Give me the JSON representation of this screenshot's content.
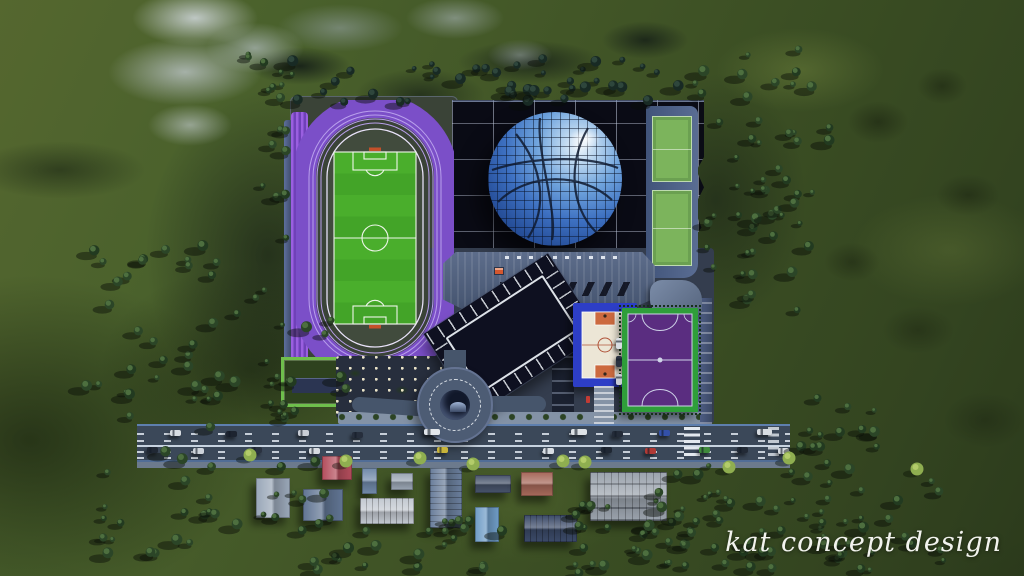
{
  "meta": {
    "watermark": "kat concept design"
  },
  "colors": {
    "terrain_green": "#3f5526",
    "mountain_rock": "#c3ccd2",
    "track_purple": "#7b4fc8",
    "field_green": "#4aae2c",
    "arena_roof": "#0a0b15",
    "dome_blue": "#3d70c1",
    "hall_roof": "#51607e",
    "road_asphalt": "#3b4859",
    "basketball_blue": "#2d3ec6",
    "futsal_purple": "#5a2d80",
    "futsal_border_green": "#2f9e3a",
    "parking_dark": "#0e1020",
    "watermark_color": "#f2f3ee"
  },
  "scene": {
    "arena": {
      "skylight_count": 8
    },
    "forest_clusters": [
      {
        "x": 288,
        "y": 58,
        "w": 404,
        "h": 44,
        "n": 42,
        "seed": 7,
        "dark": "#182a24",
        "light": "#2e463c"
      },
      {
        "x": 695,
        "y": 48,
        "w": 138,
        "h": 268,
        "n": 52,
        "seed": 11
      },
      {
        "x": 246,
        "y": 54,
        "w": 62,
        "h": 50,
        "n": 9,
        "seed": 13
      },
      {
        "x": 82,
        "y": 238,
        "w": 192,
        "h": 192,
        "n": 30,
        "seed": 17
      },
      {
        "x": 196,
        "y": 320,
        "w": 152,
        "h": 212,
        "n": 40,
        "seed": 19
      },
      {
        "x": 300,
        "y": 520,
        "w": 205,
        "h": 50,
        "n": 24,
        "seed": 23
      },
      {
        "x": 540,
        "y": 503,
        "w": 175,
        "h": 70,
        "n": 30,
        "seed": 29
      },
      {
        "x": 655,
        "y": 453,
        "w": 132,
        "h": 118,
        "n": 28,
        "seed": 31
      },
      {
        "x": 790,
        "y": 468,
        "w": 155,
        "h": 102,
        "n": 32,
        "seed": 37
      },
      {
        "x": 796,
        "y": 398,
        "w": 92,
        "h": 68,
        "n": 14,
        "seed": 41
      },
      {
        "x": 262,
        "y": 118,
        "w": 30,
        "h": 120,
        "n": 8,
        "seed": 47
      },
      {
        "x": 96,
        "y": 448,
        "w": 110,
        "h": 110,
        "n": 16,
        "seed": 53
      }
    ],
    "light_trees": [
      {
        "x": 250,
        "y": 455
      },
      {
        "x": 346,
        "y": 461
      },
      {
        "x": 420,
        "y": 458
      },
      {
        "x": 473,
        "y": 464
      },
      {
        "x": 563,
        "y": 461
      },
      {
        "x": 585,
        "y": 462
      },
      {
        "x": 729,
        "y": 467
      },
      {
        "x": 789,
        "y": 458
      },
      {
        "x": 917,
        "y": 469
      }
    ],
    "cars": [
      {
        "x": 170,
        "y": 430,
        "c": "#d8dde2"
      },
      {
        "x": 226,
        "y": 431,
        "c": "#1d2430"
      },
      {
        "x": 298,
        "y": 430,
        "c": "#c9ced6"
      },
      {
        "x": 352,
        "y": 432,
        "c": "#262e3c"
      },
      {
        "x": 424,
        "y": 429,
        "c": "#e2e6ea",
        "w": 16
      },
      {
        "x": 571,
        "y": 429,
        "c": "#dde2e6",
        "w": 16
      },
      {
        "x": 612,
        "y": 431,
        "c": "#232b38"
      },
      {
        "x": 659,
        "y": 430,
        "c": "#3350a8"
      },
      {
        "x": 757,
        "y": 429,
        "c": "#d8dde2",
        "w": 15
      },
      {
        "x": 147,
        "y": 447,
        "c": "#202834"
      },
      {
        "x": 193,
        "y": 448,
        "c": "#cdd3da"
      },
      {
        "x": 251,
        "y": 447,
        "c": "#2a3240"
      },
      {
        "x": 309,
        "y": 448,
        "c": "#d6dbe0"
      },
      {
        "x": 437,
        "y": 447,
        "c": "#c8b43a"
      },
      {
        "x": 543,
        "y": 448,
        "c": "#d9dee3"
      },
      {
        "x": 601,
        "y": 447,
        "c": "#1f2733"
      },
      {
        "x": 645,
        "y": 448,
        "c": "#b03a36"
      },
      {
        "x": 699,
        "y": 447,
        "c": "#3f8a3c"
      },
      {
        "x": 737,
        "y": 447,
        "c": "#222a36"
      },
      {
        "x": 778,
        "y": 448,
        "c": "#d4d9de"
      },
      {
        "x": 616,
        "y": 338,
        "c": "#d8dde2",
        "v": 1
      },
      {
        "x": 616,
        "y": 356,
        "c": "#2a3240",
        "v": 1
      },
      {
        "x": 616,
        "y": 374,
        "c": "#c9ced6",
        "v": 1
      }
    ],
    "houses": [
      {
        "x": 322,
        "y": 456,
        "w": 30,
        "h": 24,
        "c": "#b34d5c",
        "ridge": "v"
      },
      {
        "x": 256,
        "y": 478,
        "w": 34,
        "h": 40,
        "c": "#9aa7b8",
        "ridge": "v"
      },
      {
        "x": 303,
        "y": 489,
        "w": 40,
        "h": 32,
        "c": "#617593",
        "ridge": "v"
      },
      {
        "x": 362,
        "y": 468,
        "w": 15,
        "h": 26,
        "c": "#7089a9",
        "ridge": "h"
      },
      {
        "x": 391,
        "y": 473,
        "w": 22,
        "h": 17,
        "c": "#9aa5b3",
        "ridge": "h"
      },
      {
        "x": 360,
        "y": 498,
        "w": 54,
        "h": 26,
        "c": "#c3c9d1",
        "ridge": "h",
        "lines": "v"
      },
      {
        "x": 430,
        "y": 468,
        "w": 32,
        "h": 60,
        "c": "#6a7e9b",
        "ridge": "v",
        "lines": "h"
      },
      {
        "x": 475,
        "y": 475,
        "w": 36,
        "h": 18,
        "c": "#47536a",
        "ridge": "h"
      },
      {
        "x": 475,
        "y": 507,
        "w": 24,
        "h": 35,
        "c": "#6f9cc6",
        "ridge": "v"
      },
      {
        "x": 521,
        "y": 472,
        "w": 32,
        "h": 24,
        "c": "#a6685a",
        "ridge": "h"
      },
      {
        "x": 524,
        "y": 515,
        "w": 53,
        "h": 27,
        "c": "#3b4a68",
        "ridge": "h",
        "lines": "v"
      },
      {
        "x": 590,
        "y": 472,
        "w": 77,
        "h": 49,
        "c": "#9ba3ad",
        "ridge": "h",
        "lines": "grid"
      }
    ]
  }
}
